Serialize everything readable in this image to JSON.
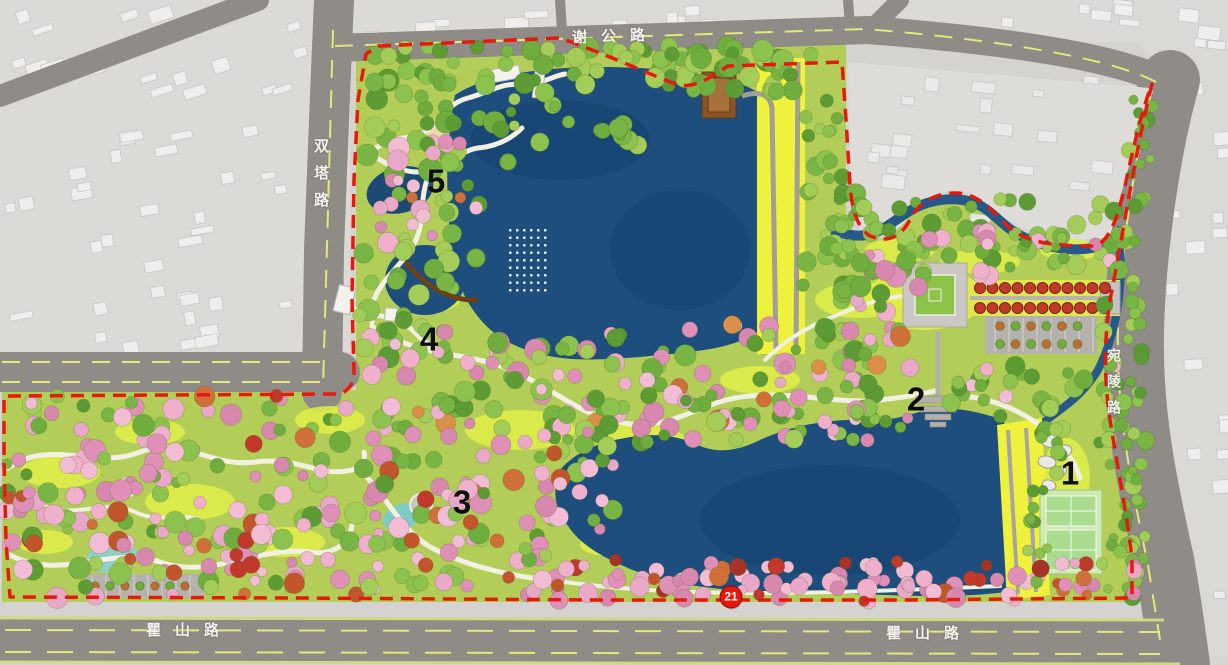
{
  "map": {
    "roads": {
      "top": {
        "label": "谢公路"
      },
      "left": {
        "label": "双塔路"
      },
      "right": {
        "label": "宛陵路"
      },
      "bottom_west": {
        "label": "瞿山路"
      },
      "bottom_east": {
        "label": "瞿山路"
      }
    },
    "markers": [
      {
        "label": "1",
        "x": 1070,
        "y": 473
      },
      {
        "label": "2",
        "x": 916,
        "y": 399
      },
      {
        "label": "3",
        "x": 462,
        "y": 502
      },
      {
        "label": "4",
        "x": 429,
        "y": 339
      },
      {
        "label": "5",
        "x": 436,
        "y": 181
      }
    ],
    "badges": [
      {
        "label": "21",
        "x": 731,
        "y": 597
      }
    ],
    "colors": {
      "boundary_red": "#e8190b",
      "lake_blue": "#1d4e7e",
      "canopy_green": "#7ab441",
      "canopy_pink": "#eaa8c8",
      "meadow_yellow": "#e0ee48",
      "causeway_yellow": "#eef23c",
      "road_gray": "#8f8b86",
      "urban_gray": "#d5d3cf"
    }
  }
}
